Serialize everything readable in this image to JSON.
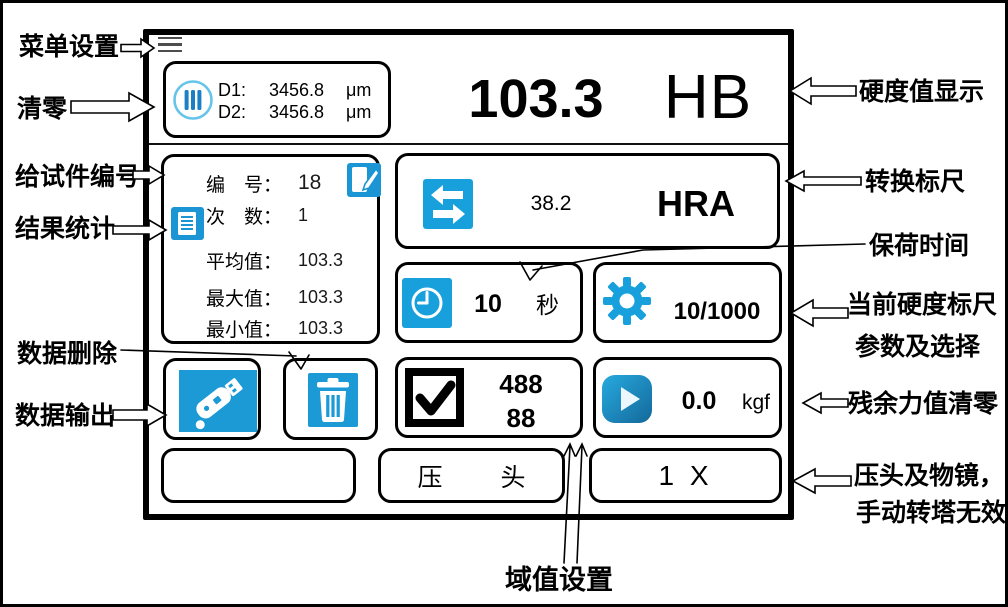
{
  "annotations": {
    "menu_settings": "菜单设置",
    "clear_zero": "清零",
    "specimen_number": "给试件编号",
    "result_stats": "结果统计",
    "data_delete": "数据删除",
    "data_output": "数据输出",
    "hardness_display": "硬度值显示",
    "conversion_scale": "转换标尺",
    "hold_time": "保荷时间",
    "current_scale_line1": "当前硬度标尺",
    "current_scale_line2": "参数及选择",
    "residual_force": "残余力值清零",
    "indenter_line1": "压头及物镜，",
    "indenter_line2": "手动转塔无效",
    "threshold_setting": "域值设置"
  },
  "screen": {
    "measurement": {
      "d1_label": "D1:",
      "d1_value": "3456.8",
      "d1_unit": "μm",
      "d2_label": "D2:",
      "d2_value": "3456.8",
      "d2_unit": "μm"
    },
    "hardness": {
      "value": "103.3",
      "scale": "HB"
    },
    "stats": {
      "rows": [
        {
          "label": "编　号：",
          "value": "18"
        },
        {
          "label": "次　数：",
          "value": "1"
        },
        {
          "label": "平均值：",
          "value": "103.3"
        },
        {
          "label": "最大值：",
          "value": "103.3"
        },
        {
          "label": "最小值：",
          "value": "103.3"
        }
      ]
    },
    "conversion": {
      "value": "38.2",
      "scale": "HRA"
    },
    "hold_time": {
      "value": "10",
      "unit": "秒"
    },
    "scale_params": {
      "value": "10/1000"
    },
    "threshold": {
      "line1": "488",
      "line2": "88"
    },
    "force": {
      "value": "0.0",
      "unit": "kgf"
    },
    "bottom": {
      "indenter_char1": "压",
      "indenter_char2": "头",
      "objective": "1 X"
    }
  },
  "icons": {
    "menu": "hamburger-icon",
    "measurement": "dial-bars-icon",
    "specimen_edit": "edit-note-icon",
    "stats": "document-icon",
    "conversion": "swap-arrows-icon",
    "hold_time": "clock-icon",
    "scale_params": "gear-icon",
    "threshold": "checkbox-icon",
    "force": "play-icon",
    "data_output": "usb-icon",
    "data_delete": "trash-icon"
  },
  "colors": {
    "accent_blue": "#1b9ad6",
    "light_blue": "#66c4ea",
    "dark_blue": "#1478aa",
    "black": "#000000",
    "white": "#ffffff"
  }
}
